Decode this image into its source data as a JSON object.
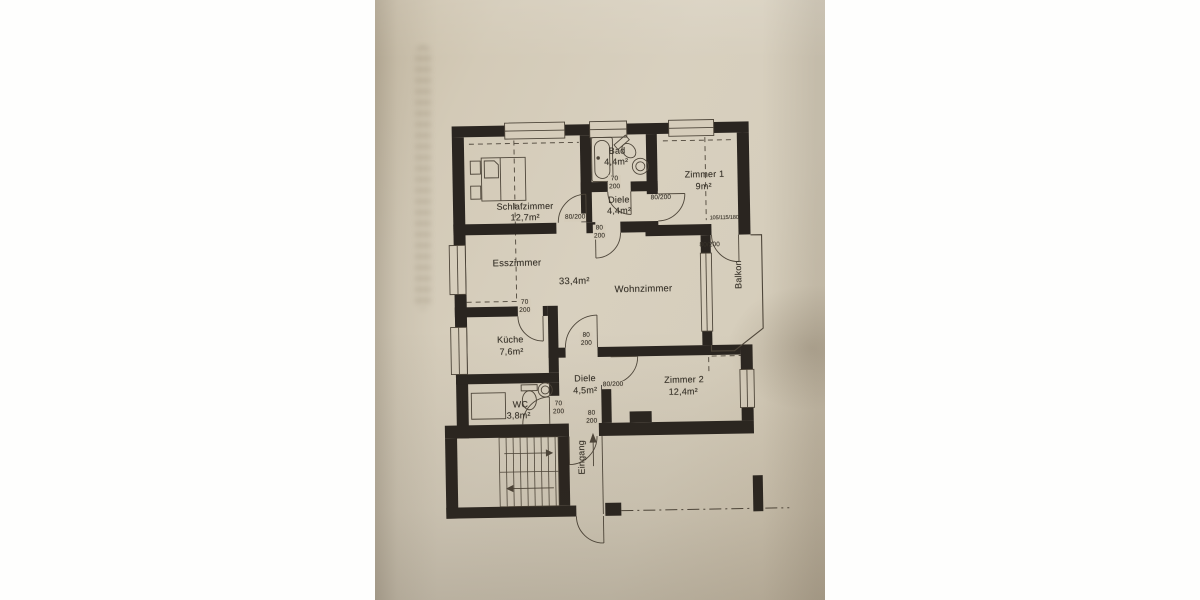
{
  "colors": {
    "background": "#fefefd",
    "paper": "#d5ccba",
    "ink_walls": "#2a2520",
    "thin_lines": "#4e463a",
    "text": "#38332a"
  },
  "rooms": {
    "schlafzimmer": {
      "name": "Schlafzimmer",
      "area": "12,7m²"
    },
    "bad": {
      "name": "Bad",
      "area": "4,4m²"
    },
    "diele_og": {
      "name": "Diele",
      "area": "4,4m²"
    },
    "zimmer1": {
      "name": "Zimmer 1",
      "area": "9m²"
    },
    "esszimmer": {
      "name": "Esszimmer"
    },
    "wohnbereich": {
      "area": "33,4m²"
    },
    "wohnzimmer": {
      "name": "Wohnzimmer"
    },
    "kueche": {
      "name": "Küche",
      "area": "7,6m²"
    },
    "diele_eg": {
      "name": "Diele",
      "area": "4,5m²"
    },
    "zimmer2": {
      "name": "Zimmer 2",
      "area": "12,4m²"
    },
    "wc": {
      "name": "WC",
      "area": "3,8m²"
    },
    "balkon": {
      "name": "Balkon"
    },
    "eingang": {
      "name": "Eingang"
    }
  },
  "doors": {
    "bad": {
      "width": "70",
      "height": "200"
    },
    "zimmer1": {
      "label": "80/200"
    },
    "schlafzimmer": {
      "label": "80/200"
    },
    "diele_og_wohnzimmer": {
      "width": "80",
      "height": "200"
    },
    "balkon": {
      "label": "80/200"
    },
    "kueche": {
      "width": "70",
      "height": "200"
    },
    "wohnzimmer_diele_eg": {
      "width": "80",
      "height": "200"
    },
    "zimmer2": {
      "label": "80/200"
    },
    "wc": {
      "width": "70",
      "height": "200"
    },
    "wohnungstuer": {
      "width": "80",
      "height": "200"
    }
  },
  "annotations": {
    "zimmer1_fenster": "105/115/180"
  },
  "icons": {
    "fixtures": [
      "bathtub",
      "toilet",
      "washbasin",
      "bed",
      "washing-machine",
      "stairs",
      "entrance-arrow"
    ]
  }
}
